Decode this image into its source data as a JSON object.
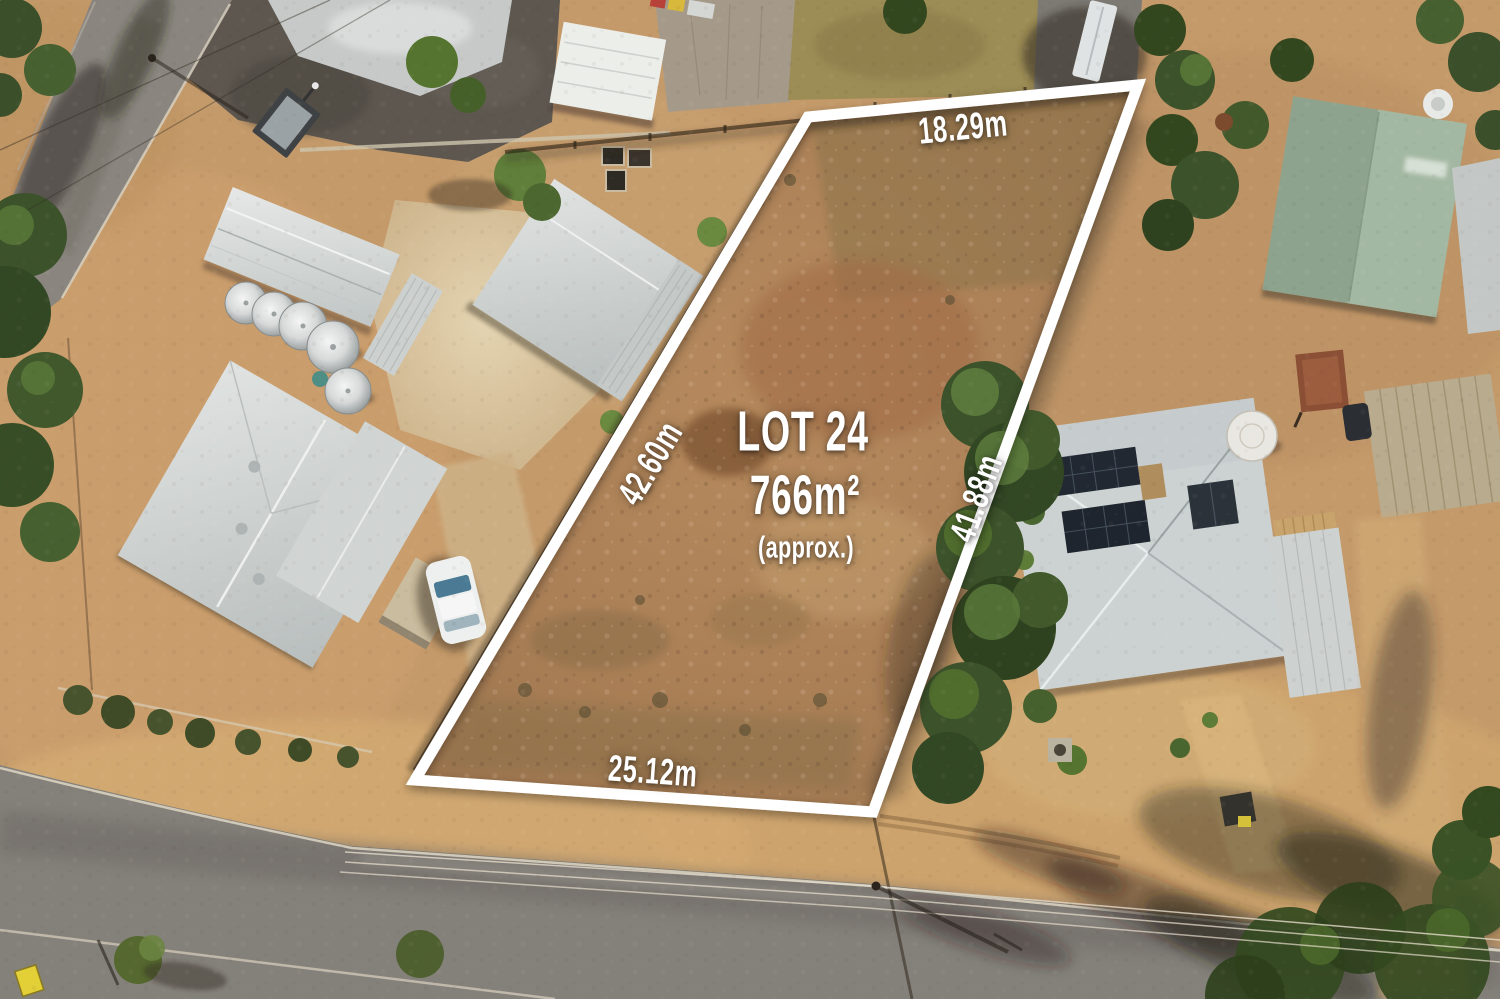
{
  "overlay": {
    "lot_label": "LOT 24",
    "area": "766m²",
    "area_qualifier": "(approx.)",
    "measurements": {
      "top": "18.29m",
      "left": "42.60m",
      "right": "41.88m",
      "bottom": "25.12m"
    }
  },
  "palette": {
    "boundary": "#ffffff",
    "label_text": "#ffffff",
    "dirt_base": "#c49a6a",
    "lot_dirt": "#ab8057",
    "verge_gold": "#d6ad72",
    "road": "#84807a",
    "asphalt_dark": "#5d574f",
    "gravel": "#c6c9c8",
    "concrete": "#dcc9a4",
    "roof_silver": "#d3d7d6",
    "roof_green": "#a3b8a2",
    "roof_tan": "#b9ab8e",
    "solar_panel": "#222832",
    "tree_green": "#3c522b",
    "car_white": "#eef0ef",
    "tank_silver": "#d9dcdb",
    "trailer_rust": "#8a4f35",
    "sign_yellow": "#e3cf36"
  }
}
